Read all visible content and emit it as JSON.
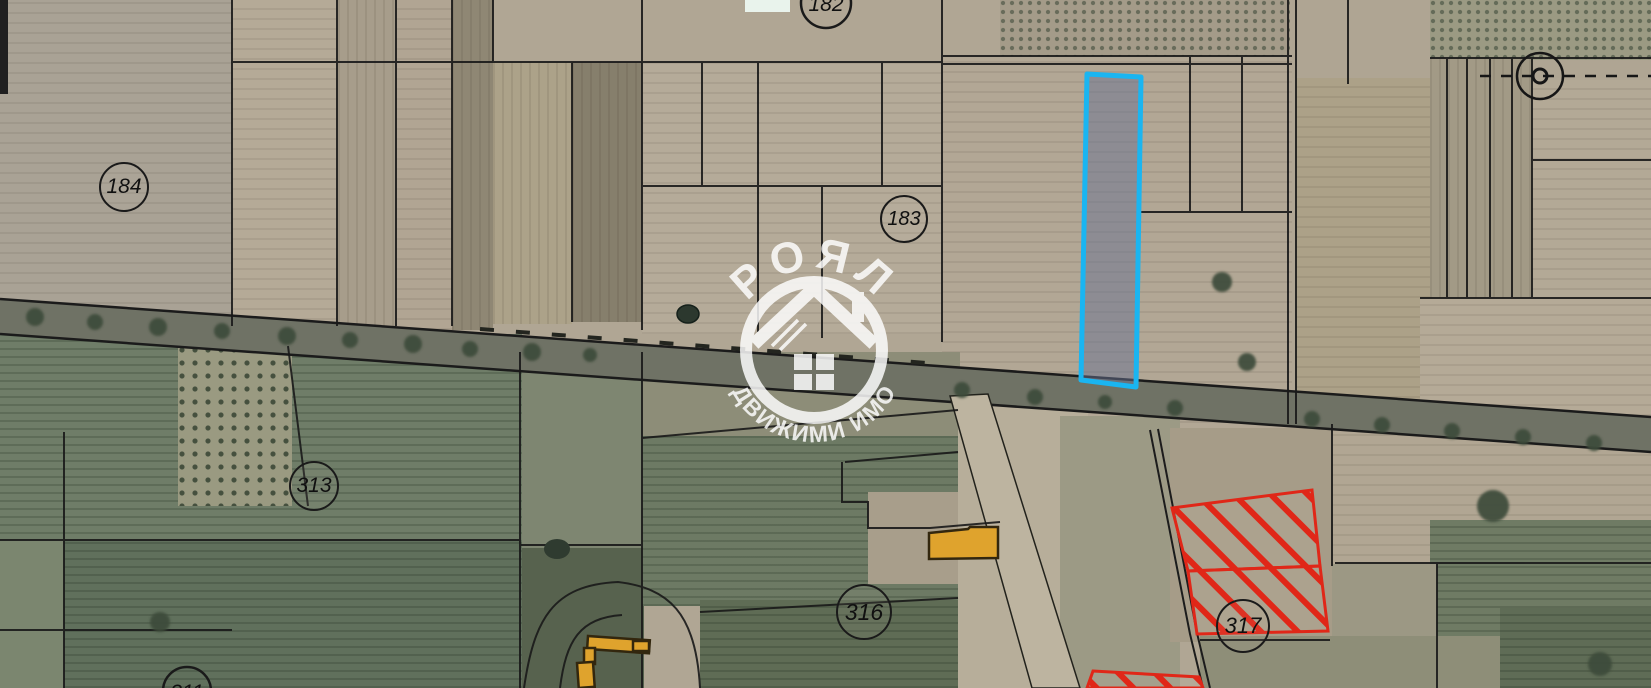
{
  "map_viewer": {
    "type": "cadastral-satellite-map",
    "watermark": {
      "title": "РОЯЛ",
      "subtitle": "НЕДВИЖИМИ ИМОТИ"
    },
    "parcel_labels": [
      {
        "number": "184"
      },
      {
        "number": "183"
      },
      {
        "number": "313"
      },
      {
        "number": "316"
      },
      {
        "number": "317"
      },
      {
        "number": "182"
      },
      {
        "number": "311"
      }
    ],
    "colors": {
      "selected_parcel_outline": "#1ab5f1",
      "selected_parcel_fill": "rgba(104,114,146,0.5)",
      "restricted_parcel_hatch": "#e02718",
      "building_fill": "#dfa32d",
      "boundary_line": "#191919",
      "road_fill": "#6f7265"
    }
  }
}
